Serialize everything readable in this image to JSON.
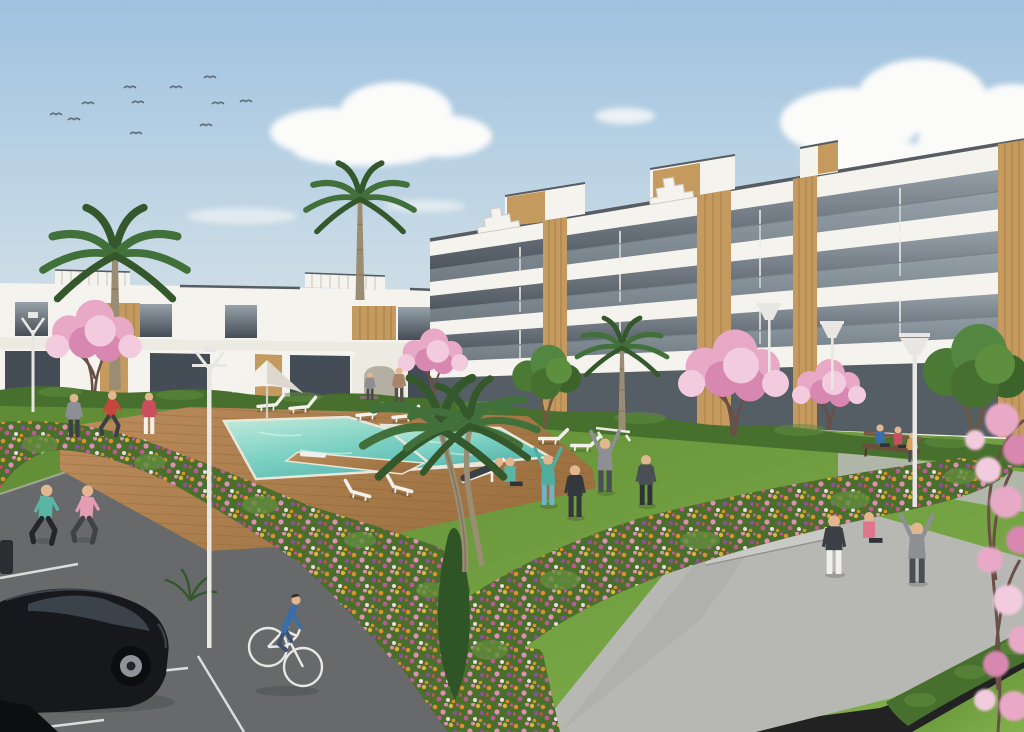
{
  "meta": {
    "width": 1024,
    "height": 732,
    "media": "3D architectural rendering, exterior daytime view"
  },
  "scene": {
    "type": "architectural-rendering",
    "description": "New-build residential complex: white modern apartment buildings with wood-slat accents around a landscaped garden with a turquoise swimming pool on a wooden deck, flower beds, palm and pink blossom trees; residents jog, cycle, stretch and relax; parking with a black hatchback in the foreground.",
    "time_of_day": "day",
    "weather": "sunny with scattered clouds"
  },
  "colors": {
    "sky_top": "#9fc2e0",
    "sky_mid": "#c6d9e5",
    "sky_bottom": "#e4e9e9",
    "cloud": "#fbfbfa",
    "birds": "#5a6a76",
    "building_white": "#f5f3ee",
    "building_cream": "#edeae2",
    "building_shadow": "#d9d4ca",
    "roof_cap": "#565c62",
    "glass_dark": "#444c55",
    "glass_light": "#97a1a9",
    "railing": "#aebcc3",
    "railing_top": "#76828a",
    "wood": "#c59a5f",
    "wood_dark": "#a57c45",
    "wood_line": "#8a6536",
    "hedge": "#47702f",
    "hedge_light": "#5f8c3c",
    "lawn_dark": "#5f8a35",
    "lawn": "#6f9d3f",
    "lawn_light": "#82b14d",
    "flower_green": "#4a6e2c",
    "flower_orange": "#db8f2d",
    "flower_yellow": "#dcb33c",
    "flower_pink": "#dd8fb4",
    "flower_magenta": "#bb5b94",
    "flower_purple": "#8d4f9e",
    "flower_white": "#ecd9e2",
    "flower_red": "#c84f5e",
    "blossom": "#e8a9c7",
    "blossom_deep": "#d887b0",
    "blossom_light": "#f3cbde",
    "branch": "#6a4f46",
    "palm_green": "#42703a",
    "palm_dark": "#34572b",
    "palm_trunk": "#9b8d74",
    "pool_shallow": "#c3ebdc",
    "pool_mid": "#7fd2c4",
    "pool_deep": "#52b4ac",
    "pool_edge": "#e9e6da",
    "deck": "#bd8d5c",
    "deck_dark": "#9c7040",
    "deck_line": "#8d6537",
    "path": "#b7b8b4",
    "step": "#c9cac5",
    "asphalt": "#67696b",
    "parking_line": "#dcdcda",
    "car_body": "#16181b",
    "car_glass": "#3c4249",
    "car_alloy": "#8f9499",
    "pole": "#e8e7e3",
    "lounger": "#f2f1ec",
    "skin": "#e2b68f"
  },
  "objects": {
    "buildings": [
      {
        "name": "terraced-apartments-left",
        "floors": 2,
        "style": "white modern, wood accent panels, roof pergolas"
      },
      {
        "name": "apartment-block-right",
        "floors": 3,
        "style": "white balcony slabs, tinted glass, vertical wood slats, stepped roof ornaments"
      },
      {
        "name": "arched-pavilion",
        "floors": 1,
        "style": "white wall with arched opening"
      }
    ],
    "amenities": {
      "pool": {
        "shape": "L-shaped with side basin and deck peninsula",
        "water": "turquoise",
        "surround": "wood deck"
      },
      "sun_loungers": 9,
      "parasols": 1,
      "benches": 3,
      "street_lamps": 5,
      "steps": 3
    },
    "vegetation": {
      "palm_trees": 5,
      "blossom_trees": 5,
      "green_trees": 2,
      "flower_beds": 2,
      "hedges": true,
      "lawns": true,
      "conifer": 1
    },
    "people": {
      "total": 20,
      "activities": [
        "jogging",
        "cycling",
        "stretching",
        "yoga",
        "lounging",
        "sitting",
        "walking"
      ]
    },
    "vehicles": {
      "cars": 1,
      "bicycles": 1
    },
    "sky": {
      "clouds": "scattered cumulus",
      "birds": 11
    }
  }
}
